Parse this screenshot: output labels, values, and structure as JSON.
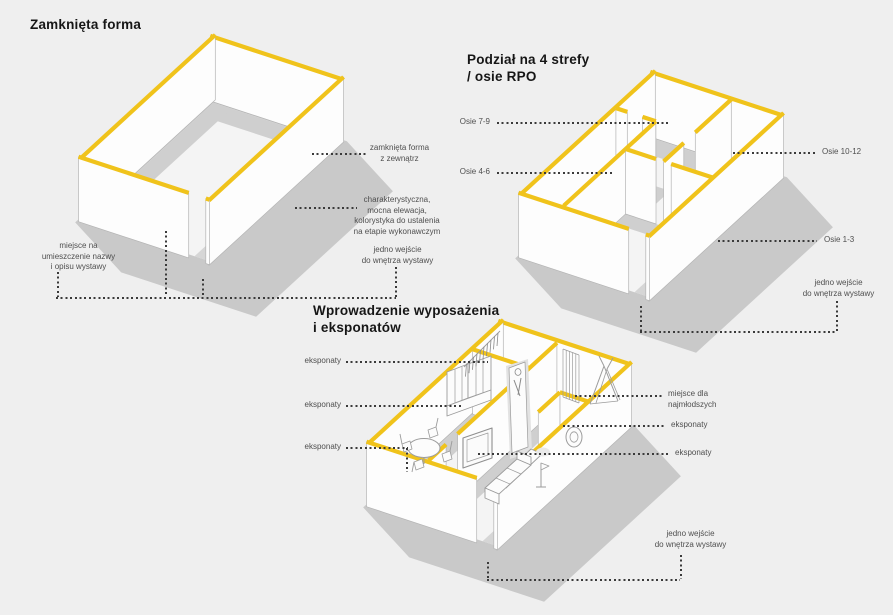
{
  "colors": {
    "background": "#efefef",
    "accent_yellow": "#f0c31b",
    "wall_white": "#fdfdfd",
    "wall_stroke": "#b4b4b4",
    "shadow_gray": "#c9c9c9",
    "floor_band_gray": "#cfcfcf",
    "leader_dot": "#3a3a3a",
    "annotation_text": "#4f4f4f",
    "title_text": "#161616"
  },
  "titles": {
    "closed_form": "Zamknięta forma",
    "zones": "Podział na 4 strefy\n/ osie RPO",
    "equipment": "Wprowadzenie wyposażenia\ni eksponatów"
  },
  "annotations": {
    "closed_form_outside": "zamknięta forma\nz zewnątrz",
    "facade": "charakterystyczna,\nmocna elewacja,\nkolorystyka do ustalenia\nna etapie wykonawczym",
    "entrance_d1": "jedno wejście\ndo wnętrza wystawy",
    "name_place": "miejsce na\numieszczenie nazwy\ni opisu wystawy",
    "axes_7_9": "Osie 7-9",
    "axes_4_6": "Osie 4-6",
    "axes_10_12": "Osie 10-12",
    "axes_1_3": "Osie 1-3",
    "entrance_d2": "jedno wejście\ndo wnętrza wystawy",
    "exhibits_left_1": "eksponaty",
    "exhibits_left_2": "eksponaty",
    "exhibits_left_3": "eksponaty",
    "kids_place": "miejsce dla\nnajmłodszych",
    "exhibits_right_1": "eksponaty",
    "exhibits_right_2": "eksponaty",
    "entrance_d3": "jedno wejście\ndo wnętrza wystawy"
  }
}
